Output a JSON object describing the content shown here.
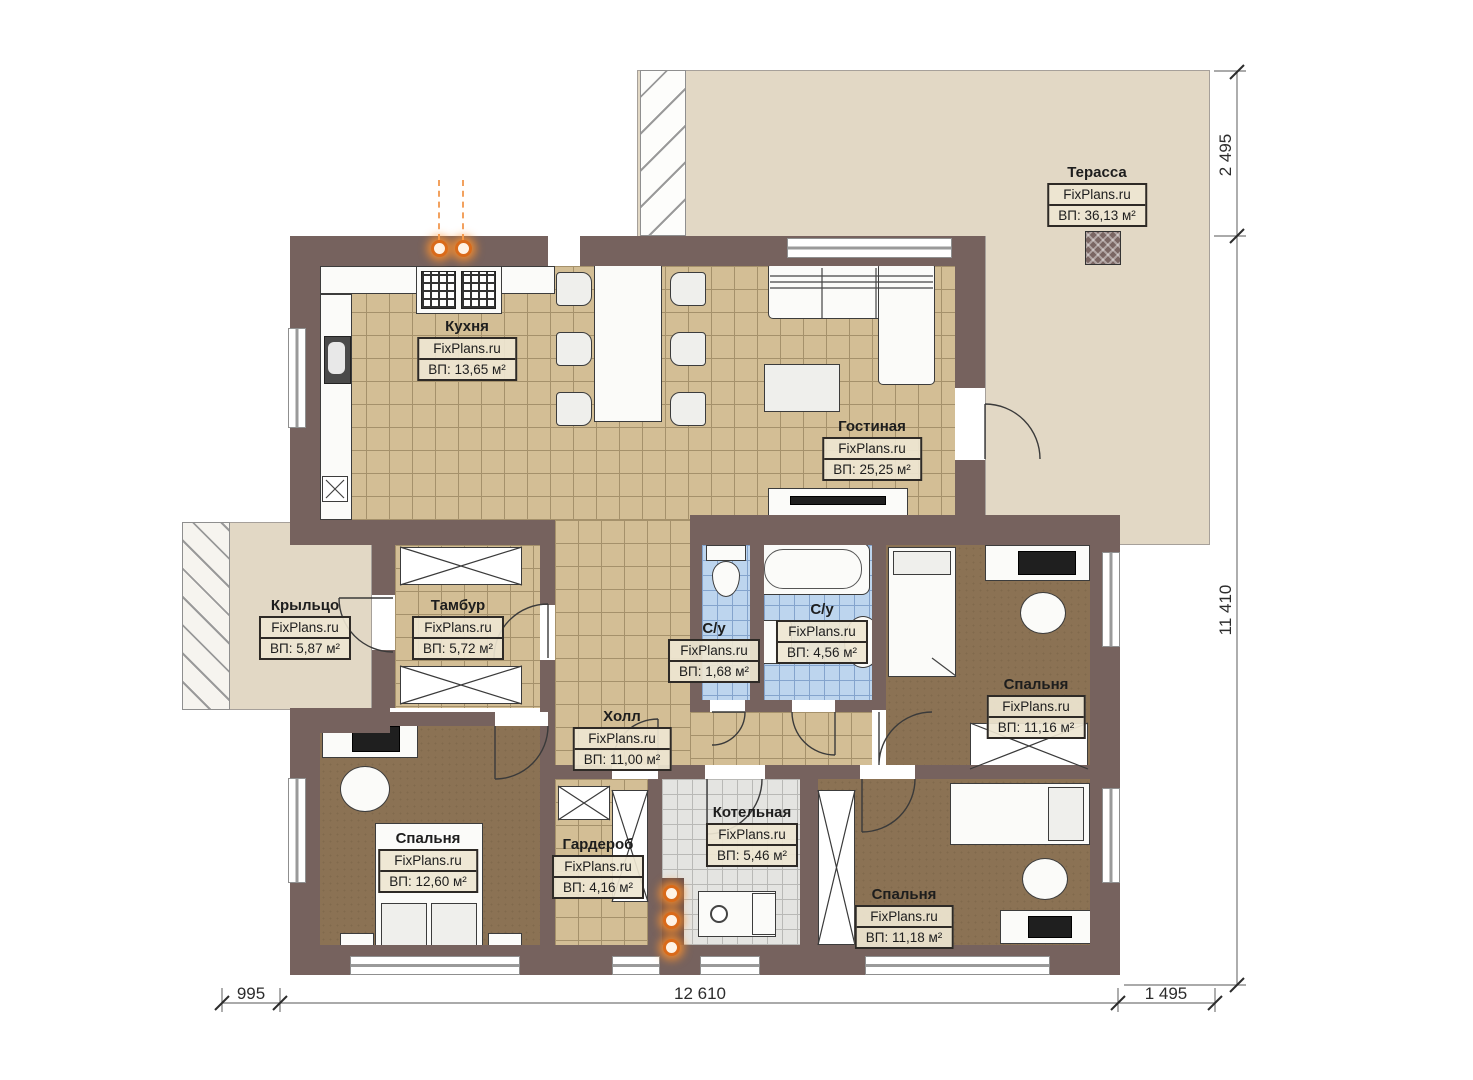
{
  "plan_title": "План 1 этажа",
  "brand": "FixPlans.ru",
  "rooms": {
    "terrace": {
      "name": "Терасса",
      "brand": "FixPlans.ru",
      "area": "ВП: 36,13 м²"
    },
    "kitchen": {
      "name": "Кухня",
      "brand": "FixPlans.ru",
      "area": "ВП: 13,65 м²"
    },
    "living": {
      "name": "Гостиная",
      "brand": "FixPlans.ru",
      "area": "ВП: 25,25 м²"
    },
    "porch": {
      "name": "Крыльцо",
      "brand": "FixPlans.ru",
      "area": "ВП: 5,87 м²"
    },
    "tambour": {
      "name": "Тамбур",
      "brand": "FixPlans.ru",
      "area": "ВП: 5,72 м²"
    },
    "wc_small": {
      "name": "С/у",
      "brand": "FixPlans.ru",
      "area": "ВП: 1,68 м²"
    },
    "wc_big": {
      "name": "С/у",
      "brand": "FixPlans.ru",
      "area": "ВП: 4,56 м²"
    },
    "bedroom_right": {
      "name": "Спальня",
      "brand": "FixPlans.ru",
      "area": "ВП: 11,16 м²"
    },
    "hall": {
      "name": "Холл",
      "brand": "FixPlans.ru",
      "area": "ВП: 11,00 м²"
    },
    "bedroom_left": {
      "name": "Спальня",
      "brand": "FixPlans.ru",
      "area": "ВП: 12,60 м²"
    },
    "wardrobe": {
      "name": "Гардероб",
      "brand": "FixPlans.ru",
      "area": "ВП: 4,16 м²"
    },
    "boiler": {
      "name": "Котельная",
      "brand": "FixPlans.ru",
      "area": "ВП: 5,46 м²"
    },
    "bedroom_bottom": {
      "name": "Спальня",
      "brand": "FixPlans.ru",
      "area": "ВП: 11,18 м²"
    }
  },
  "dimensions": {
    "top_right": "2 495",
    "right_side": "11 410",
    "bottom_left": "995",
    "bottom_center": "12 610",
    "bottom_right": "1 495"
  },
  "colors": {
    "wall": "#76625e",
    "deck": "#e2d8c5",
    "floor_tile_tan": "#d3be95",
    "floor_tile_blue": "#bdd5ee",
    "floor_tile_gray": "#e4e4e1",
    "floor_brown": "#8b7254",
    "accent_orange": "#d96a1a"
  }
}
